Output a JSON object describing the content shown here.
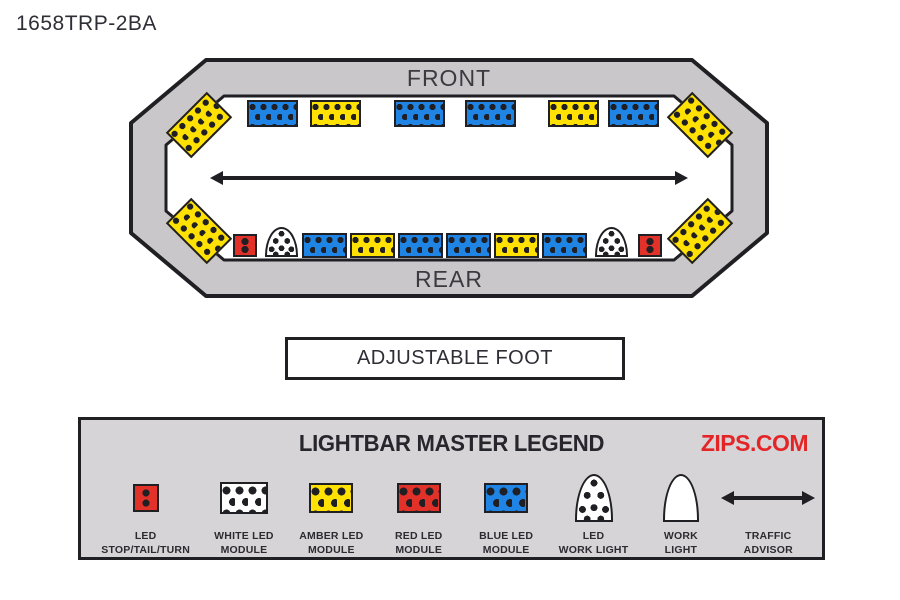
{
  "page": {
    "title": "1658TRP-2BA"
  },
  "colors": {
    "ink": "#1f1f24",
    "amber": "#ffe103",
    "blue": "#1f84e3",
    "red": "#e23128",
    "housing_gray": "#cac7ca",
    "legend_bg": "#d6d4d6",
    "zips_red": "#e42528",
    "text": "#2b2b33"
  },
  "diagram": {
    "front_label": "FRONT",
    "rear_label": "REAR",
    "foot_label": "ADJUSTABLE FOOT",
    "traffic_advisor_icon": "traffic-advisor-arrow",
    "modules": [
      {
        "type": "amber-corner",
        "name": "front-left-corner-amber-module",
        "x": 42,
        "y": 50,
        "w": 58,
        "h": 36,
        "rot": -45
      },
      {
        "type": "amber-corner",
        "name": "front-right-corner-amber-module",
        "x": 543,
        "y": 50,
        "w": 58,
        "h": 36,
        "rot": 45
      },
      {
        "type": "amber-corner",
        "name": "rear-left-corner-amber-module",
        "x": 42,
        "y": 156,
        "w": 58,
        "h": 36,
        "rot": 45
      },
      {
        "type": "amber-corner",
        "name": "rear-right-corner-amber-module",
        "x": 543,
        "y": 156,
        "w": 58,
        "h": 36,
        "rot": -45
      },
      {
        "type": "blue",
        "name": "front-blue-led-module-1",
        "x": 119,
        "y": 43,
        "w": 51,
        "h": 27
      },
      {
        "type": "amber",
        "name": "front-amber-led-module-1",
        "x": 182,
        "y": 43,
        "w": 51,
        "h": 27
      },
      {
        "type": "blue",
        "name": "front-blue-led-module-2",
        "x": 266,
        "y": 43,
        "w": 51,
        "h": 27
      },
      {
        "type": "blue",
        "name": "front-blue-led-module-3",
        "x": 337,
        "y": 43,
        "w": 51,
        "h": 27
      },
      {
        "type": "amber",
        "name": "front-amber-led-module-2",
        "x": 420,
        "y": 43,
        "w": 51,
        "h": 27
      },
      {
        "type": "blue",
        "name": "front-blue-led-module-4",
        "x": 480,
        "y": 43,
        "w": 51,
        "h": 27
      },
      {
        "type": "red-small",
        "name": "rear-left-led-stop-tail-turn",
        "x": 105,
        "y": 177,
        "w": 24,
        "h": 23
      },
      {
        "type": "led-dome",
        "name": "rear-left-led-work-light",
        "x": 137,
        "y": 170,
        "w": 33,
        "h": 30
      },
      {
        "type": "blue",
        "name": "rear-blue-led-module-1",
        "x": 174,
        "y": 176,
        "w": 45,
        "h": 25
      },
      {
        "type": "amber",
        "name": "rear-amber-led-module-1",
        "x": 222,
        "y": 176,
        "w": 45,
        "h": 25
      },
      {
        "type": "blue",
        "name": "rear-blue-led-module-2",
        "x": 270,
        "y": 176,
        "w": 45,
        "h": 25
      },
      {
        "type": "blue",
        "name": "rear-blue-led-module-3",
        "x": 318,
        "y": 176,
        "w": 45,
        "h": 25
      },
      {
        "type": "amber",
        "name": "rear-amber-led-module-2",
        "x": 366,
        "y": 176,
        "w": 45,
        "h": 25
      },
      {
        "type": "blue",
        "name": "rear-blue-led-module-4",
        "x": 414,
        "y": 176,
        "w": 45,
        "h": 25
      },
      {
        "type": "led-dome",
        "name": "rear-right-led-work-light",
        "x": 467,
        "y": 170,
        "w": 33,
        "h": 30
      },
      {
        "type": "red-small",
        "name": "rear-right-led-stop-tail-turn",
        "x": 510,
        "y": 177,
        "w": 24,
        "h": 23
      }
    ]
  },
  "legend": {
    "title": "LIGHTBAR MASTER LEGEND",
    "brand": "ZIPS.COM",
    "items": [
      {
        "icon": "led-stop-tail-turn-icon",
        "label_lines": [
          "LED",
          "STOP/TAIL/TURN"
        ]
      },
      {
        "icon": "white-led-module-icon",
        "label_lines": [
          "WHITE LED",
          "MODULE"
        ]
      },
      {
        "icon": "amber-led-module-icon",
        "label_lines": [
          "AMBER LED",
          "MODULE"
        ]
      },
      {
        "icon": "red-led-module-icon",
        "label_lines": [
          "RED LED",
          "MODULE"
        ]
      },
      {
        "icon": "blue-led-module-icon",
        "label_lines": [
          "BLUE LED",
          "MODULE"
        ]
      },
      {
        "icon": "led-work-light-icon",
        "label_lines": [
          "LED",
          "WORK LIGHT"
        ]
      },
      {
        "icon": "work-light-icon",
        "label_lines": [
          "WORK",
          "LIGHT"
        ]
      },
      {
        "icon": "traffic-advisor-icon",
        "label_lines": [
          "TRAFFIC",
          "ADVISOR"
        ]
      }
    ]
  }
}
